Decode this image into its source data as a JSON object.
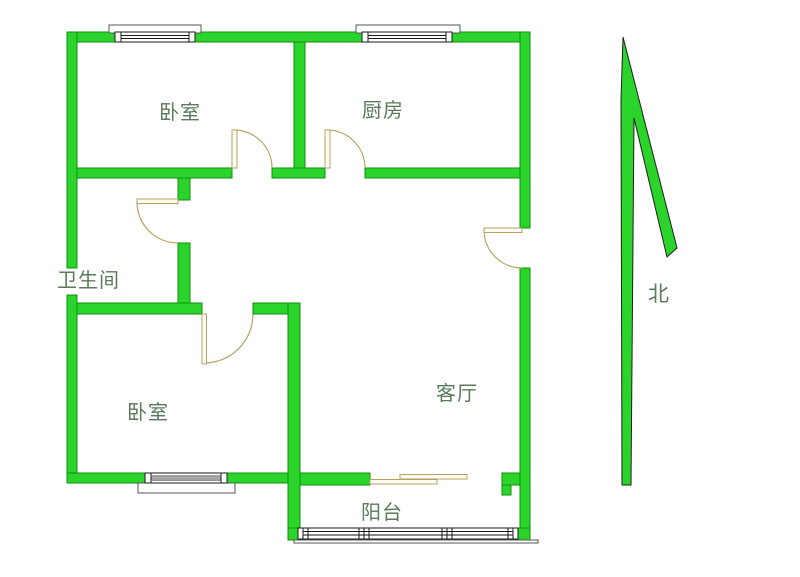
{
  "floorplan": {
    "rooms": [
      {
        "id": "bedroom-top",
        "label": "卧室"
      },
      {
        "id": "kitchen",
        "label": "厨房"
      },
      {
        "id": "bathroom",
        "label": "卫生间"
      },
      {
        "id": "bedroom-bottom",
        "label": "卧室"
      },
      {
        "id": "living-room",
        "label": "客厅"
      },
      {
        "id": "balcony",
        "label": "阳台"
      }
    ],
    "compass": {
      "label": "北"
    },
    "colors": {
      "background": "#ffffff",
      "wall_fill": "#2bd42b",
      "wall_stroke": "#0e8f0e",
      "door_stroke": "#b7a162",
      "door_fill": "#fdfcf5",
      "window_stroke": "#1a1a1a",
      "window_bar_fill": "#a9a9a9",
      "label_text": "#5a7a5a"
    }
  }
}
